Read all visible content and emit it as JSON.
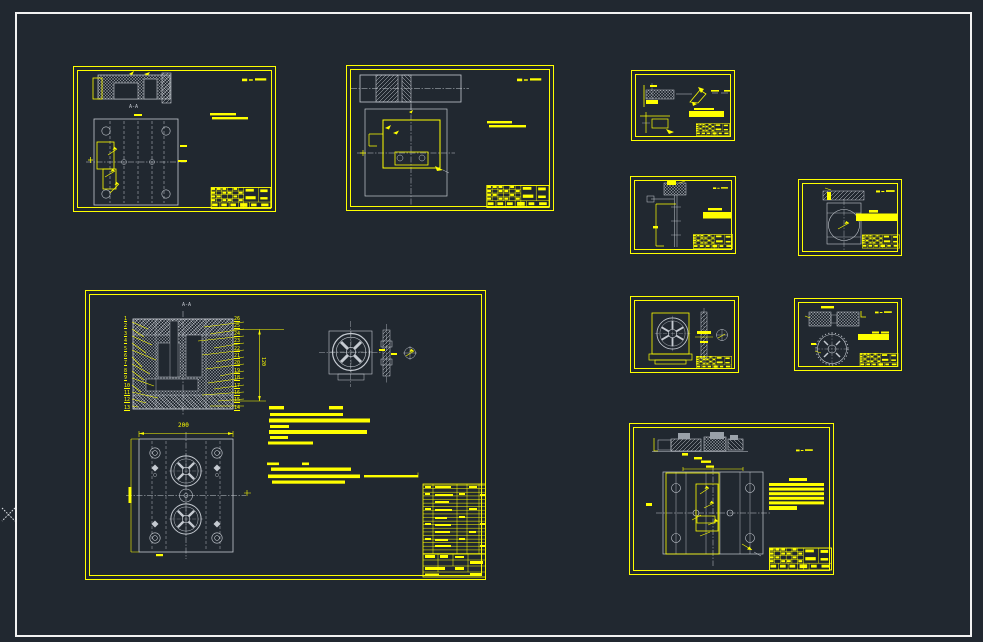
{
  "workspace": {
    "background_color": "#212830",
    "annotation_color": "#ffff00",
    "geometry_color": "#c5cad1",
    "frame_color": "#f2f2f2"
  },
  "sheets": {
    "top_left": {
      "section_label": "A-A"
    },
    "assembly": {
      "section_label": "A-A",
      "dim_top": "200",
      "dim_right": "120",
      "balloons_left": [
        "1",
        "2",
        "3",
        "4",
        "5",
        "6",
        "7",
        "8",
        "9",
        "10",
        "11",
        "12",
        "13"
      ],
      "balloons_right": [
        "26",
        "25",
        "24",
        "23",
        "22",
        "21",
        "20",
        "19",
        "18",
        "17",
        "16",
        "15",
        "14"
      ]
    }
  }
}
